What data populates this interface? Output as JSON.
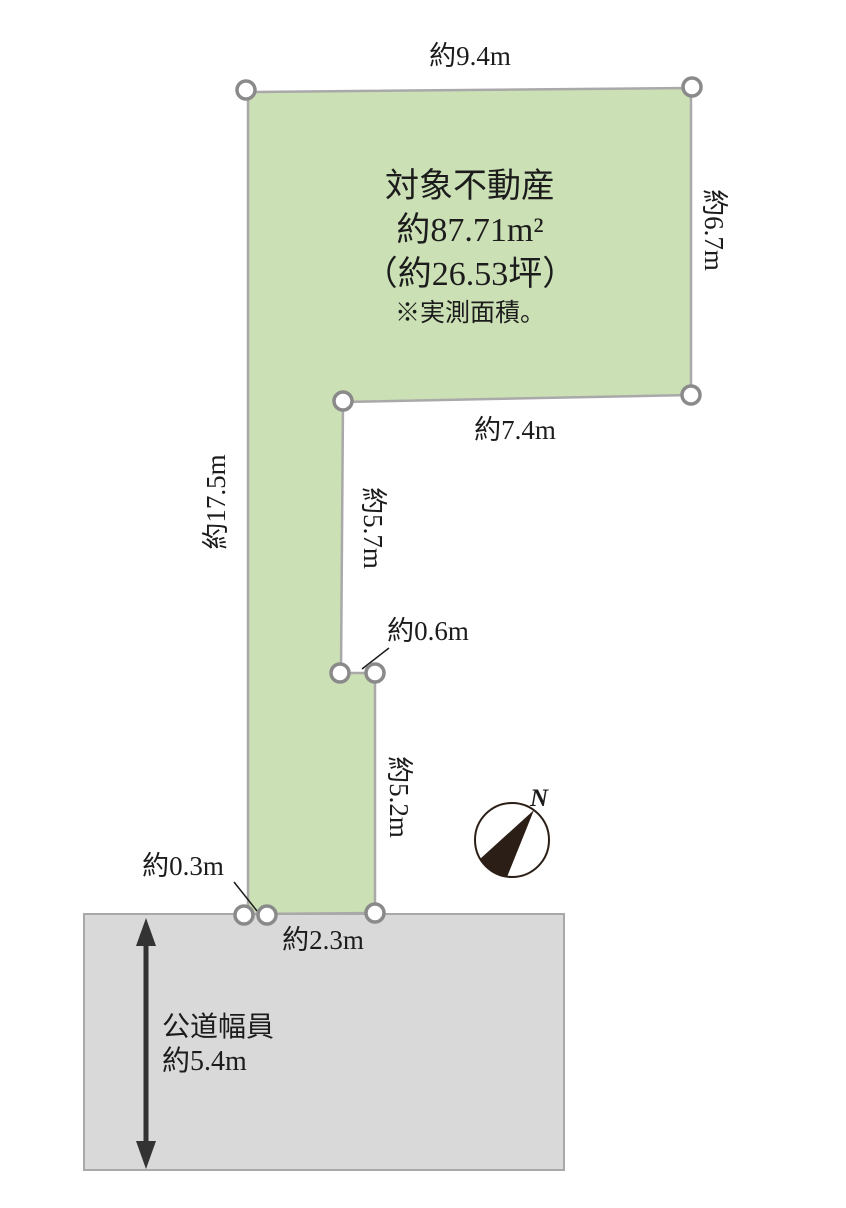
{
  "diagram": {
    "parcel": {
      "title": "対象不動産",
      "area_m2": "約87.71m²",
      "area_tsubo": "（約26.53坪）",
      "note": "※実測面積。"
    },
    "dimensions": {
      "top_edge": "約9.4m",
      "right_edge": "約6.7m",
      "middle_edge": "約7.4m",
      "inner_upper_edge": "約5.7m",
      "notch": "約0.6m",
      "inner_lower_edge": "約5.2m",
      "left_edge": "約17.5m",
      "bottom_left_jog": "約0.3m",
      "frontage": "約2.3m"
    },
    "road": {
      "label_line1": "公道幅員",
      "label_line2": "約5.4m"
    },
    "compass": {
      "north_label": "N"
    },
    "colors": {
      "parcel_fill": "#cce0b5",
      "parcel_border": "#a9a9a9",
      "road_fill": "#d9d9d9",
      "road_border": "#a9a9a9",
      "marker_stroke": "#8a8a8a",
      "text": "#1c1c1c",
      "compass_dark": "#2b1e17"
    }
  }
}
